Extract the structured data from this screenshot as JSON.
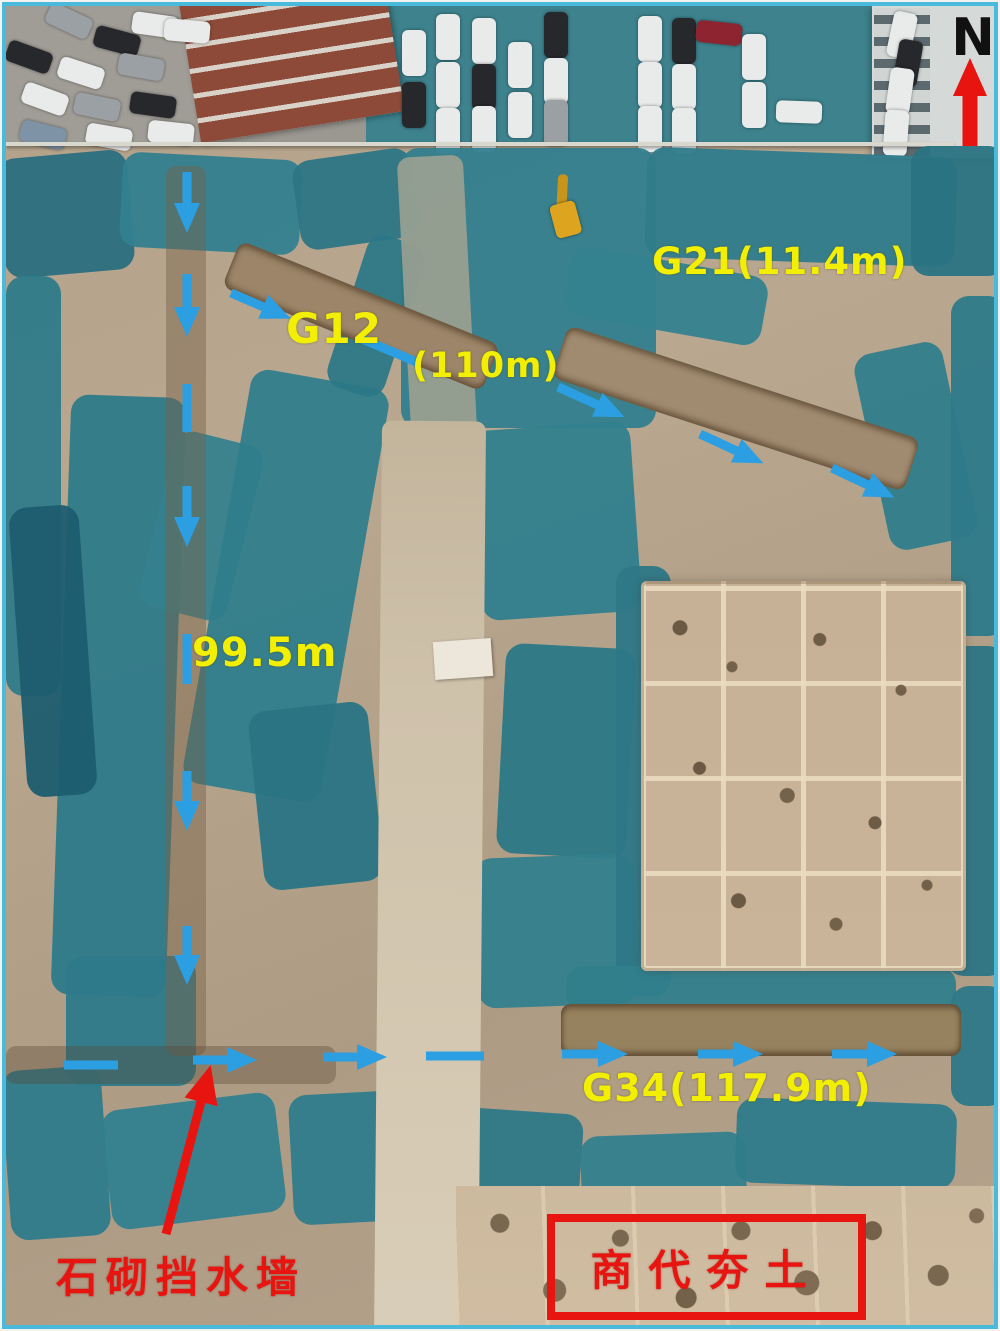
{
  "figure": {
    "description": "Aerial drone photo of an archaeological excavation site with dust nets, survey lines and labels",
    "border_color": "#49b9dc"
  },
  "north_indicator": {
    "label": "N",
    "arrow_color": "#e81410"
  },
  "annotations": {
    "g12": {
      "label": "G12"
    },
    "g12_length": {
      "label": "(110m)"
    },
    "g21": {
      "label": "G21(11.4m)"
    },
    "west_length": {
      "label": "99.5m"
    },
    "g34": {
      "label": "G34(117.9m)"
    },
    "stone_wall": {
      "label": "石砌挡水墙"
    },
    "shang_rammed_earth": {
      "label": "商代夯土"
    }
  },
  "colors": {
    "label_yellow": "#f2ee04",
    "annotation_red": "#e81410",
    "survey_arrow_blue": "#2b9fe2",
    "dust_net_teal": "#2f7d8c"
  }
}
